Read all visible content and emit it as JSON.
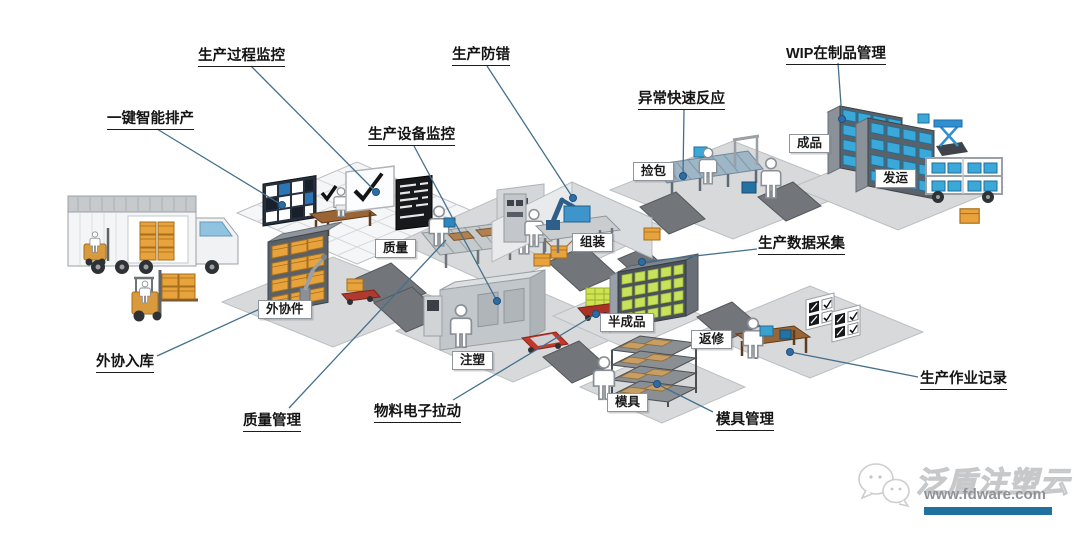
{
  "callouts": {
    "process_monitoring": "生产过程监控",
    "smart_scheduling": "一键智能排产",
    "equipment_monitoring": "生产设备监控",
    "error_proofing": "生产防错",
    "exception_response": "异常快速反应",
    "wip_management": "WIP在制品管理",
    "data_collection": "生产数据采集",
    "outsourced_inbound": "外协入库",
    "quality_management": "质量管理",
    "material_pull": "物料电子拉动",
    "mold_management": "模具管理",
    "operation_records": "生产作业记录"
  },
  "stations": {
    "finished_goods": "成品",
    "shipping": "发运",
    "picking": "捡包",
    "assembly": "组装",
    "quality": "质量",
    "outsourced_parts": "外协件",
    "injection": "注塑",
    "semi_finished": "半成品",
    "rework": "返修",
    "mold": "模具"
  },
  "watermark": {
    "brand": "泛盾注塑云",
    "url": "www.fdware.com"
  },
  "colors": {
    "connector_line": "#44708c",
    "connector_dot": "#2e6da4",
    "watermark_bar": "#20719e",
    "wip_box_blue": "#3aa8d8",
    "material_box_orange": "#e8a33d",
    "semi_finished_green": "#c9e25c",
    "agv_red": "#c0392b"
  }
}
